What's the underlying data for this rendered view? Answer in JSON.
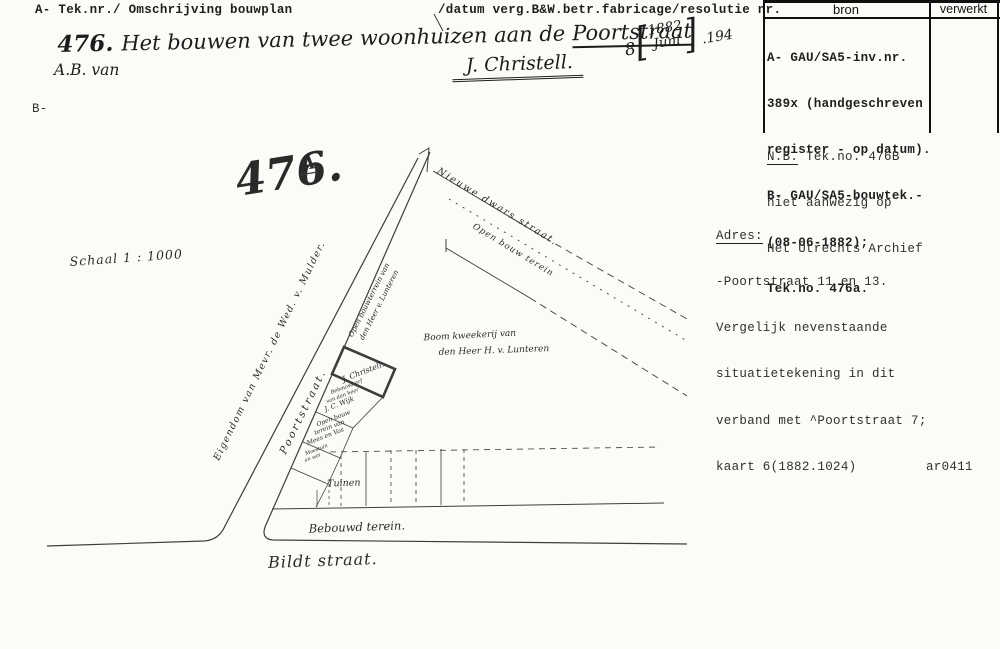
{
  "colors": {
    "paper": "#fbfbf8",
    "ink": "#1e1e1e",
    "pencil": "#3d3d3d"
  },
  "header": {
    "left": "A- Tek.nr./ Omschrijving bouwplan",
    "right": "/datum verg.B&W.betr.fabricage/resolutie nr.",
    "margin_b": "B-"
  },
  "source_table": {
    "col_bron": "bron",
    "col_verwerkt": "verwerkt",
    "bron_lines": [
      "A- GAU/SA5-inv.nr.",
      "389x (handgeschreven",
      "register - op datum).",
      "B- GAU/SA5-bouwtek.-",
      "(08-06-1882);",
      "Tek.no. 476a."
    ],
    "nb_label": "N.B.",
    "nb_line1_rest": " Tek.no. 476B",
    "nb_line2": "niet aanwezig op",
    "nb_line3": "Het Utrechts Archief"
  },
  "adres": {
    "title": "Adres:",
    "line1": "-Poortstraat 11 en 13.",
    "line2": "Vergelijk nevenstaande",
    "line3": "situatietekening in dit",
    "line4": "verband met ^Poortstraat 7;",
    "line5": "kaart 6(1882.1024)",
    "code": "ar0411"
  },
  "handwriting": {
    "number": "476.",
    "title": "Het bouwen van twee woonhuizen aan de",
    "street": "Poortstraat",
    "applicant": "A.B. van",
    "signature": "J. Christell.",
    "date": {
      "day": "8",
      "year": "1882",
      "month": "Juni",
      "suffix": ".194"
    }
  },
  "drawing": {
    "labels": {
      "plan_no": "476.",
      "plan_suffix": "A",
      "schaal": "Schaal 1 : 1000",
      "eigendom": "Eigendom van Mevr. de Wed. v. Mulder.",
      "poortstraat": "Poortstraat.",
      "nieuwe_dwarsstraat": "Nieuwe dwars straat.",
      "open_bouwterrein": "Open bouw terein",
      "lunteren_strip_1": "Open bouwterrein van",
      "lunteren_strip_2": "den Heer v. Lunteren",
      "christell": "J. Christell.",
      "lot_1": "Bebouwd erf",
      "lot_2": "van den heer",
      "lot_3": "J. C. Wijk",
      "lot_4": "Open bouw",
      "lot_5": "terein van",
      "lot_6": "Mees en Vos",
      "lot_7": "Moestuin",
      "lot_8": "en wei",
      "boomkweekerij_1": "Boom kweekerij van",
      "boomkweekerij_2": "den Heer  H. v. Lunteren",
      "tuinen": "Tuinen",
      "bebouwd_terein": "Bebouwd terein.",
      "bildtstraat": "Bildt straat."
    }
  }
}
